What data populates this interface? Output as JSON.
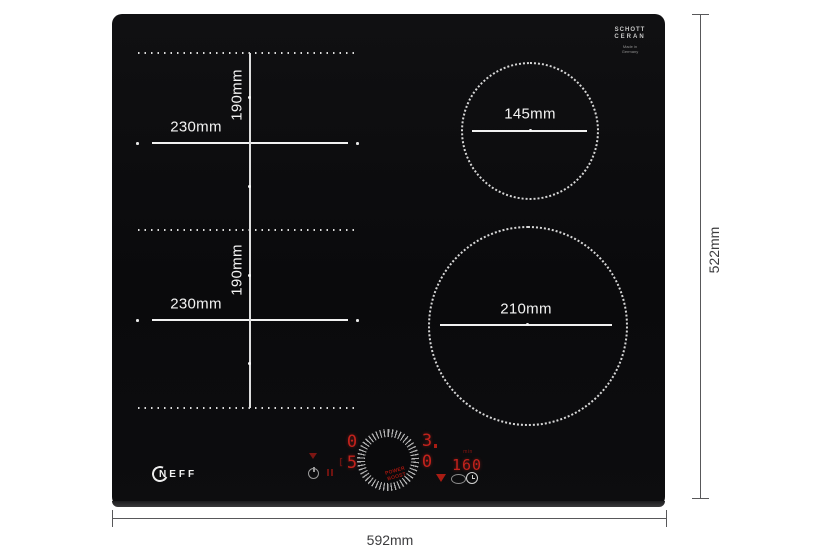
{
  "hob": {
    "brand": "NEFF",
    "glass_logo": {
      "line1": "SCHOTT",
      "line2": "CERAN",
      "sub1": "Made in",
      "sub2": "Germany"
    },
    "zones": {
      "flex_top": {
        "width": "230mm",
        "height": "190mm"
      },
      "flex_bottom": {
        "width": "230mm",
        "height": "190mm"
      },
      "small_ring": {
        "diameter": "145mm"
      },
      "large_ring": {
        "diameter": "210mm"
      }
    },
    "controls": {
      "left_zone": {
        "top": "0",
        "bottom": "5",
        "bracket": "["
      },
      "right_zone": {
        "top": "3",
        "bottom": "0"
      },
      "timer": {
        "value": "160",
        "unit": "min"
      },
      "dial": {
        "line1": "POWER",
        "line2": "BOOST"
      }
    }
  },
  "outer_dimensions": {
    "width": "592mm",
    "height": "522mm"
  },
  "colors": {
    "glass": "#0a0a0c",
    "led_red": "#c3221c",
    "dim_red": "#8a1713",
    "dim_gray": "#58585a"
  }
}
